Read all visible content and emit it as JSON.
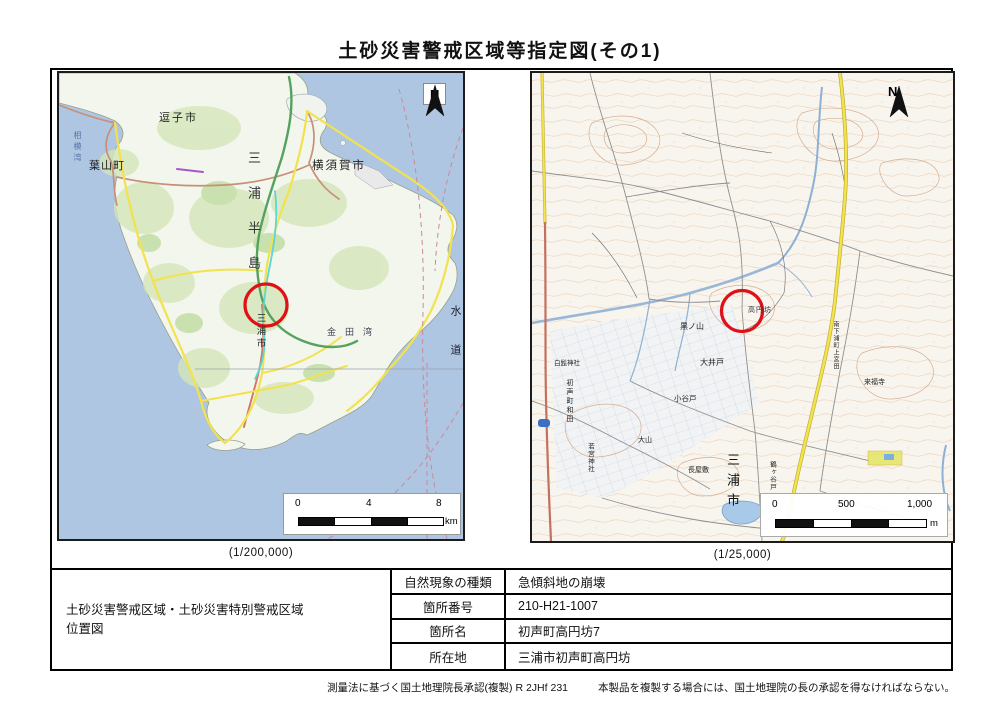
{
  "page": {
    "title": "土砂災害警戒区域等指定図(その1)",
    "footer_approval": "測量法に基づく国土地理院長承認(複製) R 2JHf 231",
    "footer_notice": "本製品を複製する場合には、国土地理院の長の承認を得なければならない。"
  },
  "colors": {
    "site_circle_red": "#e01018",
    "sea_blue": "#aec6e2",
    "road_yellow": "#f2e24e",
    "expressway_green": "#55a25f"
  },
  "left_map": {
    "caption": "(1/200,000)",
    "north_label": "N",
    "scale": {
      "t0": "0",
      "t1": "4",
      "t2": "8",
      "unit": "km"
    },
    "labels": {
      "sagami_bay": "相模湾",
      "zushi_city": "逗子市",
      "hayama_town": "葉山町",
      "yokosuka_city": "横須賀市",
      "miura_peninsula": "三浦半島",
      "miura_city": "三浦市",
      "kaneda_bay": "金田湾",
      "uraga_suido": "水道"
    }
  },
  "right_map": {
    "caption": "(1/25,000)",
    "north_label": "N",
    "scale": {
      "t0": "0",
      "t1": "500",
      "t2": "1,000",
      "unit": "m"
    },
    "labels": {
      "kouenbou": "高円坊",
      "kuronoyama": "黒ノ山",
      "oido": "大井戸",
      "koyato": "小谷戸",
      "shirahige_jinja": "白髭神社",
      "hassemachi_wada": "初声町和田",
      "wakamiya_jinja": "若宮神社",
      "miura_city": "三浦市",
      "nagayashiki": "長屋敷",
      "ooyama": "大山",
      "raifukuji": "来福寺",
      "minamishitaura_kamimiyada": "南下浦町上宮田",
      "tsurugayato": "鶴ヶ谷戸"
    }
  },
  "info_table": {
    "position_title_line1": "土砂災害警戒区域・土砂災害特別警戒区域",
    "position_title_line2": "位置図",
    "rows": [
      {
        "label": "自然現象の種類",
        "value": "急傾斜地の崩壊"
      },
      {
        "label": "箇所番号",
        "value": "210-H21-1007"
      },
      {
        "label": "箇所名",
        "value": "初声町高円坊7"
      },
      {
        "label": "所在地",
        "value": "三浦市初声町高円坊"
      }
    ]
  }
}
